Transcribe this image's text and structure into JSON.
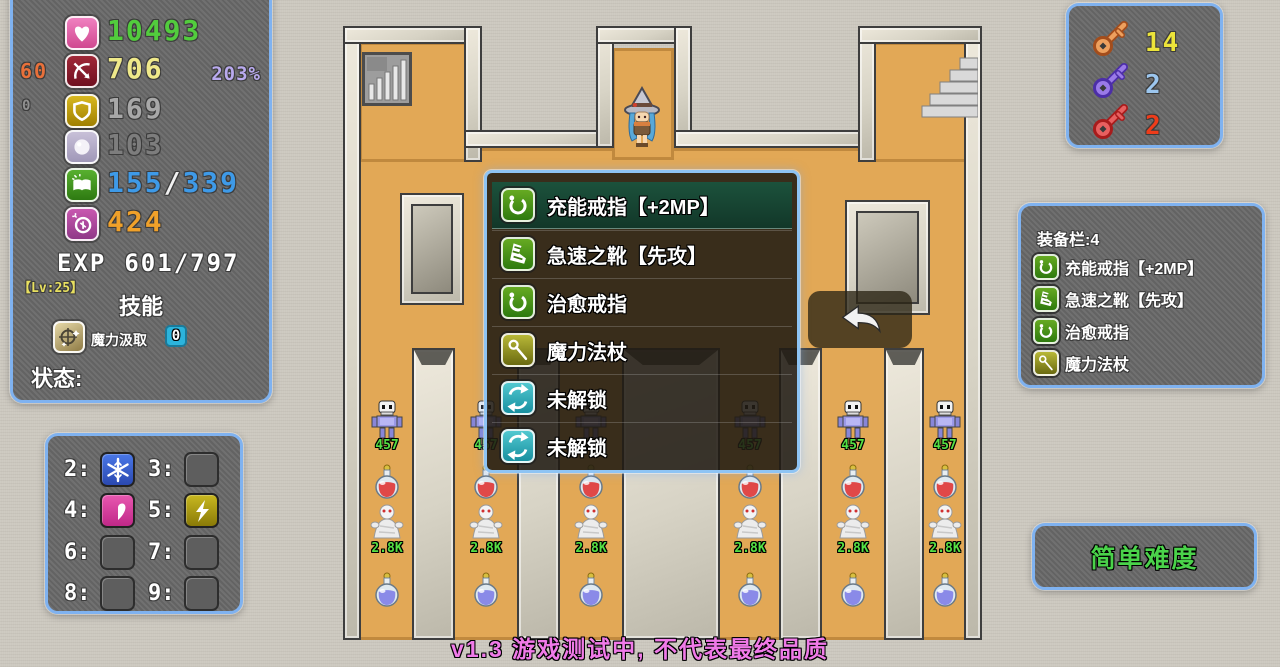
{
  "colors": {
    "panel_border": "#7fb2f0",
    "hp_green": "#52cc3d",
    "attack_yellow": "#efe98a",
    "mp_blue": "#3e9ae8",
    "coin_orange": "#f0a12a",
    "floor_orange": "#e2a856",
    "enemy_hp_green": "#55e044",
    "version_pink": "#f07ae8",
    "difficulty_green": "#4ad24a"
  },
  "stats_panel": {
    "hp": "10493",
    "attack": "706",
    "attack_extra": "60",
    "attack_percent": "203%",
    "defense": "169",
    "defense_extra": "0",
    "magic_defense": "103",
    "mp_current": "155",
    "mp_divider": "/",
    "mp_max": "339",
    "coins": "424",
    "exp_label": "EXP",
    "exp_value": "601/797",
    "level_label": "【Lv:25】",
    "skills_header": "技能",
    "skill_name": "魔力汲取",
    "skill_count": "0",
    "status_label": "状态:"
  },
  "keys_panel": {
    "yellow_count": "14",
    "blue_count": "2",
    "red_count": "2"
  },
  "equipment_panel": {
    "title": "装备栏:4",
    "items": [
      {
        "icon": "ring-icon",
        "label": "充能戒指【+2MP】"
      },
      {
        "icon": "boot-icon",
        "label": "急速之靴【先攻】"
      },
      {
        "icon": "ring-icon",
        "label": "治愈戒指"
      },
      {
        "icon": "staff-icon",
        "label": "魔力法杖"
      }
    ]
  },
  "popup_menu": {
    "items": [
      {
        "icon": "ring-icon",
        "label": "充能戒指【+2MP】",
        "selected": true
      },
      {
        "icon": "boot-icon",
        "label": "急速之靴【先攻】",
        "selected": false
      },
      {
        "icon": "ring-icon",
        "label": "治愈戒指",
        "selected": false
      },
      {
        "icon": "staff-icon",
        "label": "魔力法杖",
        "selected": false
      },
      {
        "icon": "refresh-icon",
        "label": "未解锁",
        "selected": false
      },
      {
        "icon": "refresh-icon",
        "label": "未解锁",
        "selected": false
      }
    ]
  },
  "hotkey_panel": {
    "slots": [
      {
        "key": "2:",
        "skill": "frost"
      },
      {
        "key": "3:",
        "skill": null
      },
      {
        "key": "4:",
        "skill": "half-heart"
      },
      {
        "key": "5:",
        "skill": "lightning"
      },
      {
        "key": "6:",
        "skill": null
      },
      {
        "key": "7:",
        "skill": null
      },
      {
        "key": "8:",
        "skill": null
      },
      {
        "key": "9:",
        "skill": null
      }
    ]
  },
  "difficulty_button": {
    "label": "简单难度"
  },
  "map": {
    "skeleton_hp": "457",
    "mummy_hp": "2.8K",
    "corridor_count": 6
  },
  "footer": {
    "version_text": "v1.3 游戏测试中, 不代表最终品质"
  }
}
